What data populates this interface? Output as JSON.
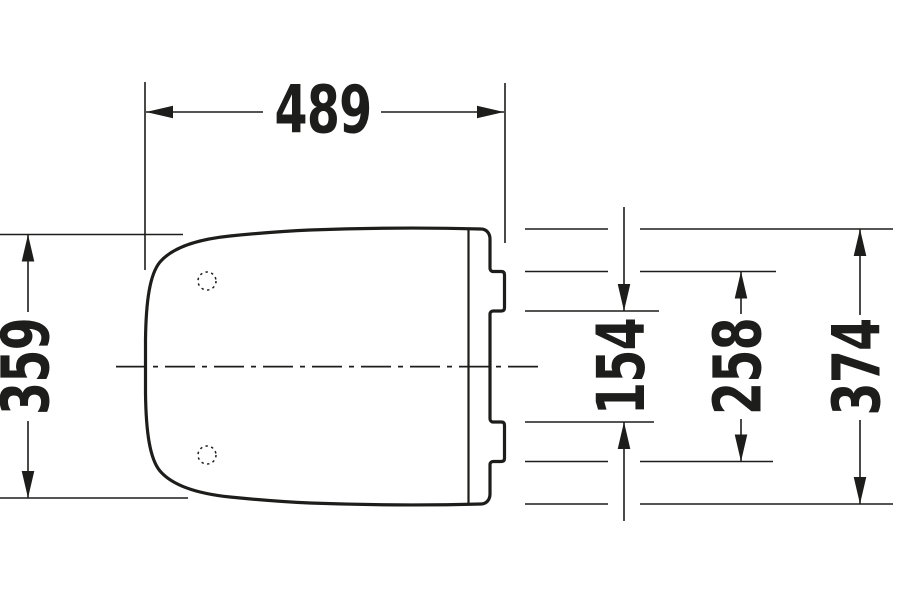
{
  "drawing": {
    "type": "technical-dimension-drawing",
    "subject": "toilet seat lid with hinge tabs, top view",
    "line_color": "#1d1d1b",
    "background_color": "#ffffff",
    "dimensions": {
      "overall_length": {
        "value": "489",
        "orientation": "horizontal",
        "position": "top"
      },
      "front_width": {
        "value": "359",
        "orientation": "vertical",
        "position": "left"
      },
      "hinge_tab_inner_spacing": {
        "value": "154",
        "orientation": "vertical",
        "position": "right-inner"
      },
      "hinge_tab_outer_spacing": {
        "value": "258",
        "orientation": "vertical",
        "position": "right-middle"
      },
      "overall_width": {
        "value": "374",
        "orientation": "vertical",
        "position": "right-outer"
      }
    },
    "features": {
      "hinge_holes_count": 2,
      "hinge_tabs_count": 2,
      "centerline_style": "dash-dot"
    }
  }
}
